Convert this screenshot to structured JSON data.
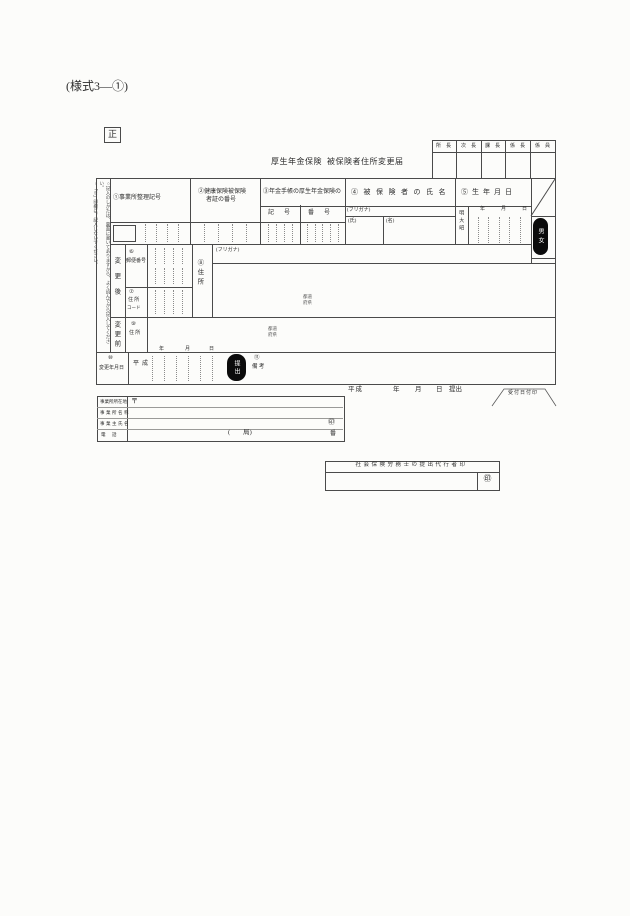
{
  "form": {
    "code": "(様式3—①)",
    "copy_mark": "正",
    "title_system": "厚生年金保険",
    "title_name": "被保険者住所変更届"
  },
  "approval_box": {
    "columns": [
      "所長",
      "次長",
      "課長",
      "係長",
      "係員"
    ]
  },
  "instructions": {
    "line1": "○記入のしかたは、裏面に書いてありますから、よく読んでから記入してください。",
    "line2": "○「※」印欄は、記入しないでください。"
  },
  "columns": {
    "office_code": "①事業所整理記号",
    "health_cert_line1": "②健康保険被保険",
    "health_cert_line2": "者証の番号",
    "pension_book": "③年金手帳の厚生年金保険の",
    "pension_kigo": "記　号",
    "pension_bango": "番　号",
    "insured_name": "④被保険者の氏名",
    "birth_date": "⑤生年月日"
  },
  "name_field": {
    "furigana": "(フリガナ)",
    "last": "(氏)",
    "first": "(名)"
  },
  "birth_field": {
    "eras": "明大昭",
    "unit_year": "年",
    "unit_month": "月",
    "unit_day": "日",
    "marker": "男女"
  },
  "after_change": {
    "row_label": "変更後",
    "postal_num": "⑥",
    "postal_label": "郵便番号",
    "addr_code_num": "⑦",
    "addr_code_label1": "住 所",
    "addr_code_label2": "コード",
    "address_label": "⑧住所",
    "furigana": "(フリガナ)",
    "pref_note1": "都道",
    "pref_note2": "府県"
  },
  "before_change": {
    "row_label": "変更前",
    "address_num": "⑨",
    "address_label": "住 所",
    "pref_note1": "都道",
    "pref_note2": "府県"
  },
  "change_date": {
    "num": "⑩",
    "label": "変更年月日",
    "era": "平成",
    "unit_year": "年",
    "unit_month": "月",
    "unit_day": "日",
    "marker": "提出",
    "remarks_num": "⑪",
    "remarks_label": "備 考"
  },
  "employer": {
    "address_label": "事業所所在地",
    "name_label": "事業所名称",
    "owner_label": "事業主氏名",
    "phone_label": "電　話",
    "postal_mark": "〒",
    "phone_hint": "(　　局)",
    "seal": "㊞",
    "phone_suffix": "番"
  },
  "submission": {
    "era": "平成",
    "unit_year": "年",
    "unit_month": "月",
    "unit_day": "日",
    "suffix": "提出",
    "receipt_stamp": "受付日付印"
  },
  "sr_agent": {
    "title": "社会保険労務士の提出代行者印",
    "seal": "㊞"
  }
}
